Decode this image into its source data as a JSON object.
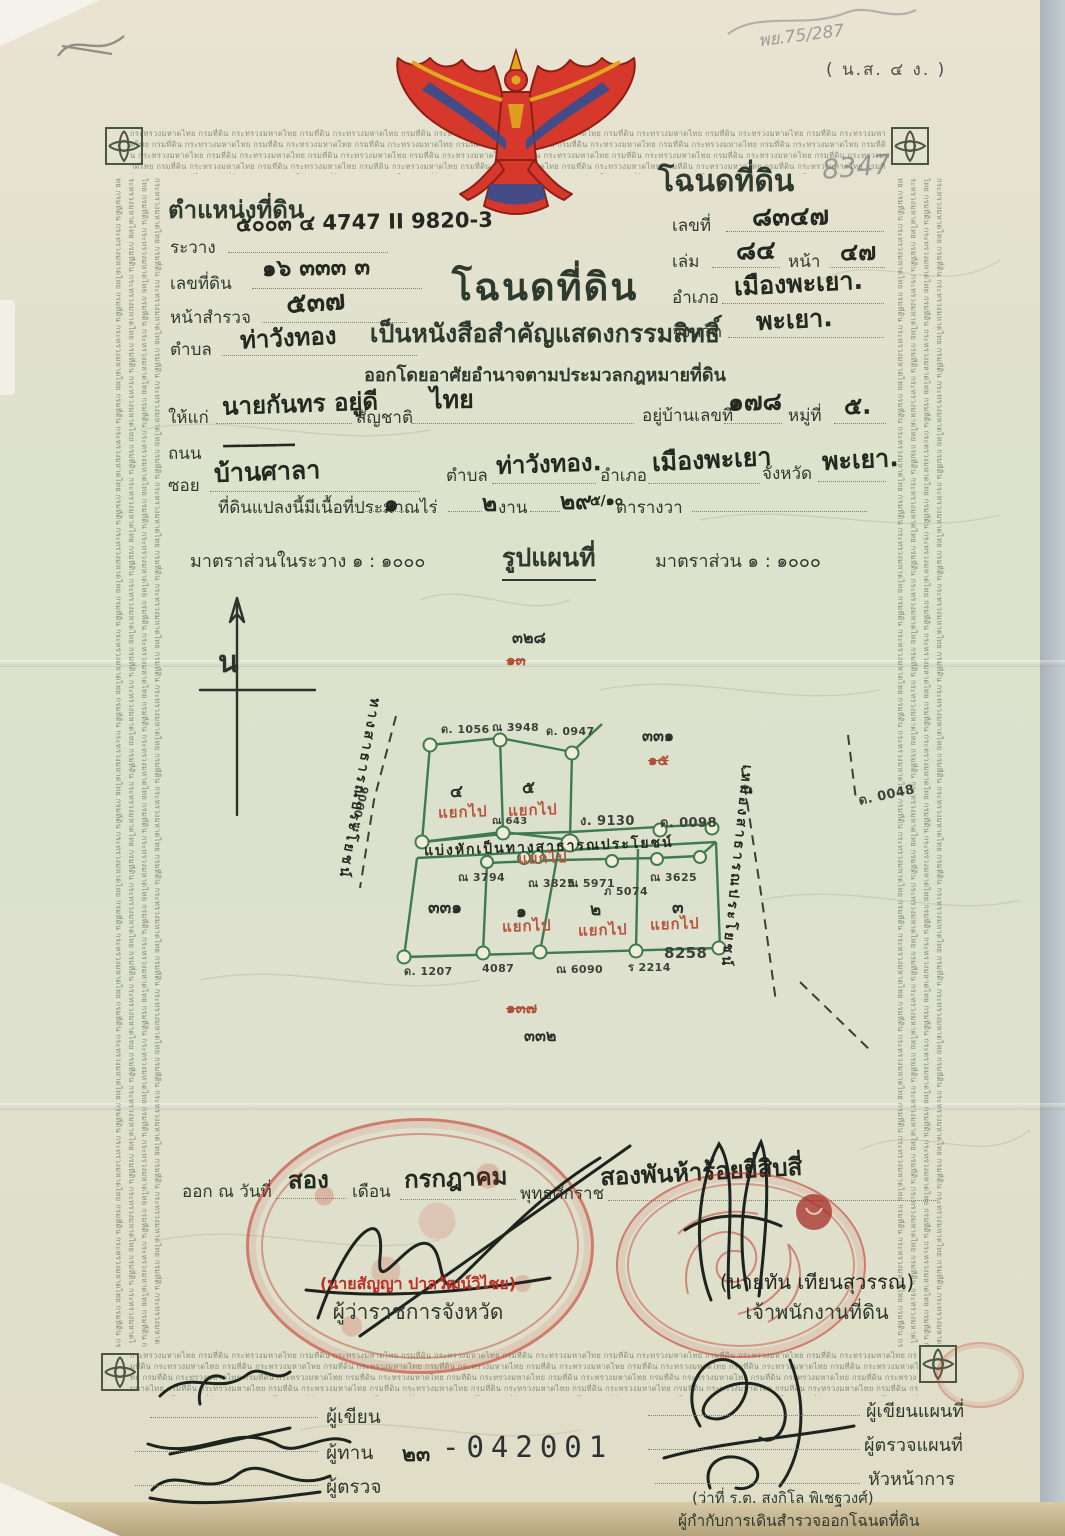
{
  "notes": {
    "form_code": "( น.ส. ๔ ง. )",
    "pencil_ref": "พย.75/287",
    "pencil_deed_no": "8347"
  },
  "border": {
    "repeat_text": "กระทรวงมหาดไทย กรมที่ดิน "
  },
  "position_block": {
    "title": "ตำแหน่งที่ดิน",
    "rawang_label": "ระวาง",
    "rawang_value": "๕๐๐๓ ๔  4747 II 9820-3",
    "parcel_label": "เลขที่ดิน",
    "parcel_value": "๑๖   ๓๓๓   ๓",
    "survey_label": "หน้าสำรวจ",
    "survey_value": "๕๓๗",
    "tambon_label": "ตำบล",
    "tambon_value": "ท่าวังทอง"
  },
  "deed_block": {
    "title": "โฉนดที่ดิน",
    "no_label": "เลขที่",
    "no_value": "๘๓๔๗",
    "book_label": "เล่ม",
    "book_value": "๘๔",
    "page_label": "หน้า",
    "page_value": "๔๗",
    "amphoe_label": "อำเภอ",
    "amphoe_value": "เมืองพะเยา.",
    "changwat_label": "จังหวัด",
    "changwat_value": "พะเยา."
  },
  "heading": {
    "title": "โฉนดที่ดิน",
    "subtitle": "เป็นหนังสือสำคัญแสดงกรรมสิทธิ์",
    "authority": "ออกโดยอาศัยอำนาจตามประมวลกฎหมายที่ดิน"
  },
  "grantee": {
    "to_label": "ให้แก่",
    "name": "นายกันทร  อยู่ดี",
    "nationality_label": "สัญชาติ",
    "nationality": "ไทย",
    "house_label": "อยู่บ้านเลขที่",
    "house_no": "๑๗๘",
    "moo_label": "หมู่ที่",
    "moo": "๕.",
    "road_label": "ถนน",
    "road_value": "————",
    "soi_label": "ซอย",
    "soi_value": "บ้านศาลา",
    "tambon_label": "ตำบล",
    "tambon": "ท่าวังทอง.",
    "amphoe_label": "อำเภอ",
    "amphoe": "เมืองพะเยา",
    "changwat_label": "จังหวัด",
    "changwat": "พะเยา."
  },
  "area": {
    "prefix": "ที่ดินแปลงนี้มีเนื้อที่ประมาณ",
    "rai": "๑",
    "rai_unit": "ไร่",
    "ngan": "๒",
    "ngan_unit": "งาน",
    "wa": "๒๙",
    "wa_fraction": "๕/๑๐",
    "wa_unit": "ตารางวา"
  },
  "scale": {
    "in_rawang": "มาตราส่วนในระวาง  ๑ : ๑๐๐๐",
    "map_title": "รูปแผนที่",
    "map_scale": "มาตราส่วน  ๑ : ๑๐๐๐"
  },
  "map": {
    "compass": "น",
    "left_road": "ทางสาธารณประโยชน์",
    "right_canal": "เหมืองสาธารณประโยชน์",
    "road_note": "แบ่งหักเป็นทางสาธารณประโยชน์",
    "split": "แยกไป",
    "parcels": [
      "๔",
      "๕",
      "๓๓๑",
      "๑",
      "๒",
      "๓"
    ],
    "refs": {
      "top_new": "๓๒๘",
      "top_old": "๑๓",
      "right_new": "๓๓๑",
      "right_old": "๑๕",
      "bottom_old": "๑๓๗",
      "bottom_new": "๓๓๒"
    },
    "markers": [
      "ด. 1056",
      "ณ 3948",
      "ด. 0947",
      "ณ 0906",
      "ณ 643",
      "ง. 9130",
      "ด. 0098",
      "ด. 0048",
      "ณ 3794",
      "ณ 3825",
      "ณ 5971",
      "ภ 5074",
      "ณ 3625",
      "ด. 1207",
      "4087",
      "ณ 6090",
      "ร 2214",
      "8258"
    ]
  },
  "issue": {
    "prefix": "ออก ณ วันที่",
    "day": "สอง",
    "month_label": "เดือน",
    "month": "กรกฎาคม",
    "era_label": "พุทธศักราช",
    "year": "สองพันห้าร้อยยี่สิบสี่"
  },
  "officials": {
    "governor_name": "(นายสัญญา ปาลวัฒน์วิไชย)",
    "governor_title": "ผู้ว่าราชการจังหวัด",
    "land_officer_name": "(นายทัน เทียนสุวรรณ)",
    "land_officer_title": "เจ้าพนักงานที่ดิน",
    "survey_chief_name": "(ว่าที่ ร.ต. สงกิโล พิเชฐวงศ์)",
    "survey_chief_title": "ผู้กำกับการเดินสำรวจออกโฉนดที่ดิน"
  },
  "sign_labels": {
    "writer": "ผู้เขียน",
    "reader": "ผู้ทาน",
    "inspector": "ผู้ตรวจ",
    "map_writer": "ผู้เขียนแผนที่",
    "map_inspector": "ผู้ตรวจแผนที่",
    "chief": "หัวหน้าการ"
  },
  "doc_number": {
    "thai": "๒๓",
    "digits": "-042001"
  }
}
